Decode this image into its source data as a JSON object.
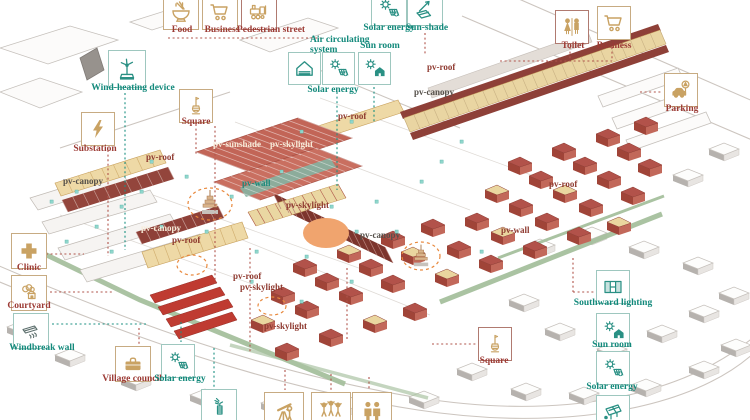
{
  "colors": {
    "label_maroon": "#9c3a34",
    "label_teal": "#12897b",
    "icon_gold": "#c9a263",
    "icon_teal": "#2a9084",
    "roof_red": "#b2524a",
    "canopy_maroon": "#8e4038",
    "roof_tan": "#ead69f",
    "hedge_green": "#a6c09e",
    "highlight_orange": "#e8883c"
  },
  "legend": {
    "food": {
      "label": "Food",
      "icon": "noodle-bowl-icon"
    },
    "business_top": {
      "label": "Business",
      "icon": "shopping-cart-icon"
    },
    "pedestrian_street": {
      "label": "Pedestrian street",
      "icon": "hand-cart-icon"
    },
    "air_circulating": {
      "label": "Air circulating system",
      "icon": "vented-house-icon"
    },
    "solar_energy_mid": {
      "label": "Solar energy",
      "icon": "sun-panel-icon"
    },
    "sun_room_mid": {
      "label": "Sun room",
      "icon": "sun-house-icon"
    },
    "solar_energy_top": {
      "label": "Solar energy",
      "icon": "sun-panel-icon"
    },
    "sun_shade": {
      "label": "Sun-shade",
      "icon": "shade-panel-icon"
    },
    "toilet": {
      "label": "Toilet",
      "icon": "toilet-icon"
    },
    "business_right": {
      "label": "Business",
      "icon": "shopping-cart-icon"
    },
    "parking": {
      "label": "Parking",
      "icon": "car-sign-icon"
    },
    "wind_heating": {
      "label": "Wind-heating device",
      "icon": "wind-turbine-icon"
    },
    "square_left": {
      "label": "Square",
      "icon": "monument-icon"
    },
    "substation": {
      "label": "Substation",
      "icon": "lightning-icon"
    },
    "clinic": {
      "label": "Clinic",
      "icon": "medical-cross-icon"
    },
    "courtyard": {
      "label": "Courtyard",
      "icon": "courtyard-house-icon"
    },
    "windbreak_wall": {
      "label": "Windbreak wall",
      "icon": "windbreak-icon"
    },
    "village_council": {
      "label": "Village council",
      "icon": "briefcase-icon"
    },
    "solar_energy_bottom": {
      "label": "Solar energy",
      "icon": "sun-panel-icon"
    },
    "southward_lighting": {
      "label": "Southward lighting",
      "icon": "window-icon"
    },
    "sun_room_right": {
      "label": "Sun room",
      "icon": "sun-house-icon"
    },
    "solar_energy_right": {
      "label": "Solar energy",
      "icon": "sun-panel-icon"
    },
    "square_right": {
      "label": "Square",
      "icon": "monument-icon"
    }
  },
  "map_labels": {
    "pv_roof": "pv-roof",
    "pv_canopy": "pv-canopy",
    "pv_sunshade": "pv-sunshade",
    "pv_skylight": "pv-skylight",
    "pv_wall": "pv-wall"
  }
}
